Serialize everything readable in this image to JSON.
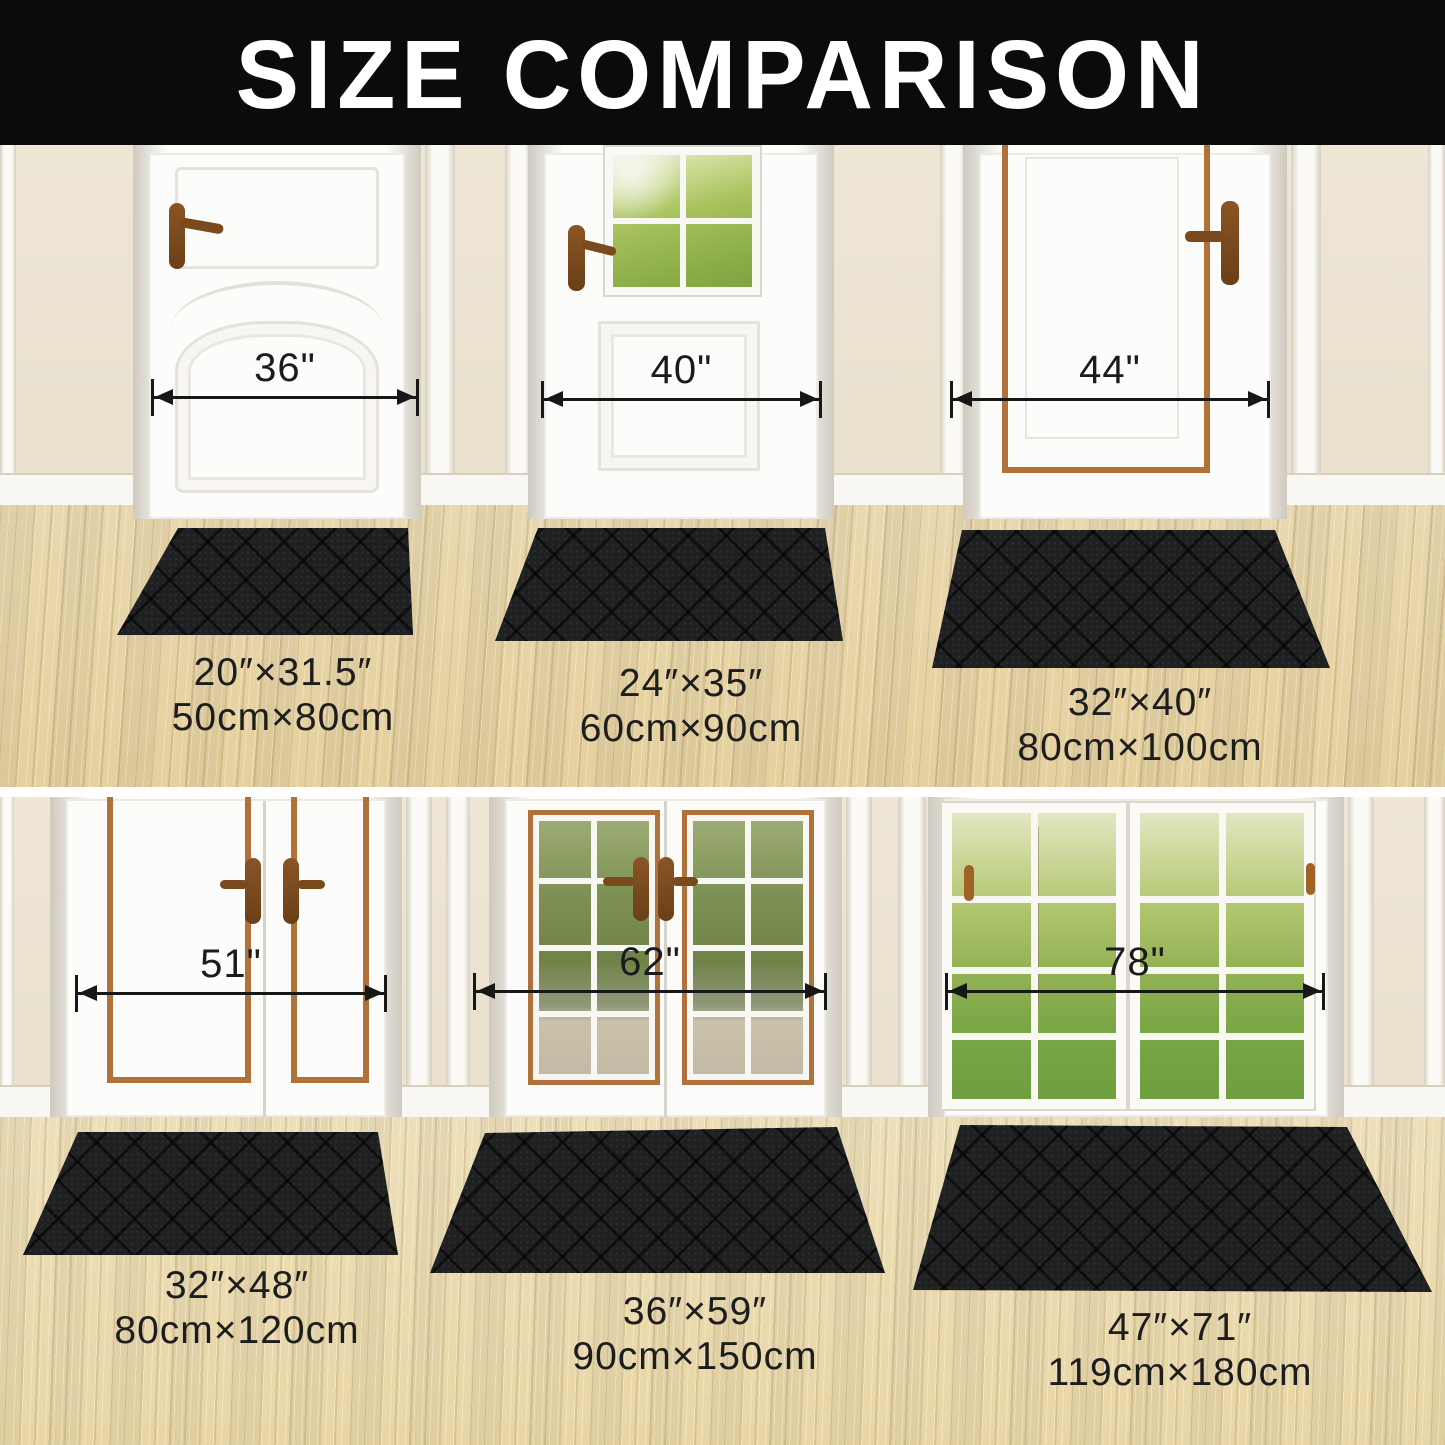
{
  "title": "SIZE COMPARISON",
  "rows": [
    {
      "name": "single-doors",
      "doors": [
        {
          "width_label": "36\""
        },
        {
          "width_label": "40\""
        },
        {
          "width_label": "44\""
        }
      ],
      "mats": [
        {
          "inches": "20″×31.5″",
          "cm": "50cm×80cm"
        },
        {
          "inches": "24″×35″",
          "cm": "60cm×90cm"
        },
        {
          "inches": "32″×40″",
          "cm": "80cm×100cm"
        }
      ]
    },
    {
      "name": "double-doors",
      "doors": [
        {
          "width_label": "51\""
        },
        {
          "width_label": "62\""
        },
        {
          "width_label": "78\""
        }
      ],
      "mats": [
        {
          "inches": "32″×48″",
          "cm": "80cm×120cm"
        },
        {
          "inches": "36″×59″",
          "cm": "90cm×150cm"
        },
        {
          "inches": "47″×71″",
          "cm": "119cm×180cm"
        }
      ]
    }
  ],
  "colors": {
    "banner_bg": "#0b0b0b",
    "title_text": "#ffffff",
    "wall": "#efe6d6",
    "floor_top": "#e9d8ae",
    "floor_bottom": "#eddfb8",
    "mat": "#1f2022",
    "copper": "#b0713a",
    "handle_dark": "#754718",
    "measure_text": "#1b1b1b",
    "baseboard": "#f8f7f3"
  }
}
